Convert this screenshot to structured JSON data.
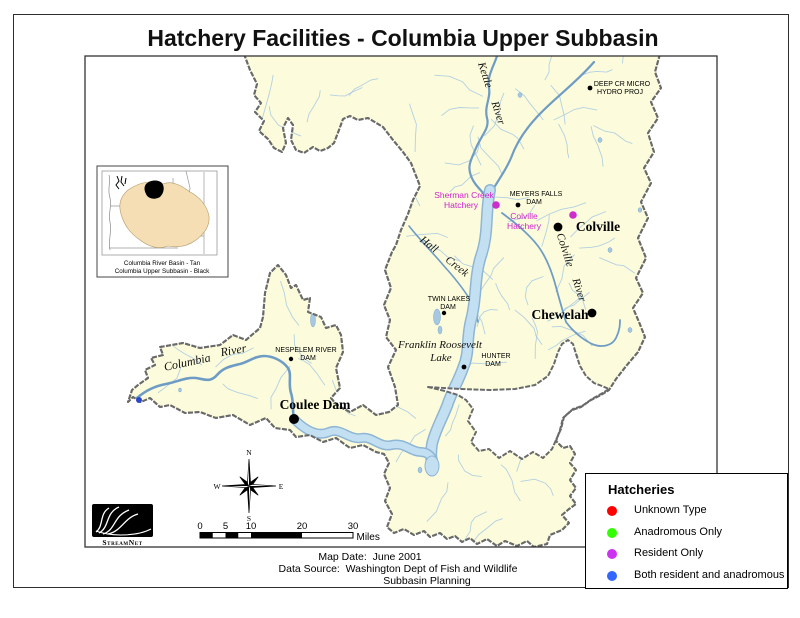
{
  "page": {
    "title": "Hatchery Facilities - Columbia Upper Subbasin"
  },
  "inset": {
    "caption_line1": "Columbia River Basin - Tan",
    "caption_line2": "Columbia Upper Subbasin - Black",
    "basin_color": "#F5DEB3",
    "subbasin_color": "#000000"
  },
  "compass": {
    "n": "N",
    "e": "E",
    "s": "S",
    "w": "W"
  },
  "logo": {
    "text": "StreamNet"
  },
  "scalebar": {
    "ticks": [
      "0",
      "5",
      "10",
      "20",
      "30"
    ],
    "unit": "Miles"
  },
  "footer": {
    "line1": "Map Date:  June 2001",
    "line2": "Data Source:  Washington Dept of Fish and Wildlife",
    "line3": "Subbasin Planning"
  },
  "legend": {
    "title": "Hatcheries",
    "items": [
      {
        "label": "Unknown Type",
        "color": "#FF0000"
      },
      {
        "label": "Anadromous Only",
        "color": "#33FF00"
      },
      {
        "label": "Resident Only",
        "color": "#CC33EE"
      },
      {
        "label": "Both resident and anadromous",
        "color": "#3366FF"
      }
    ]
  },
  "map": {
    "colors": {
      "basin": "#FCFCDC",
      "boundary": "#6A6A6A",
      "stream": "#A6C8E2",
      "river": "#6F9CC4",
      "lake_fill": "#C2E0F2",
      "lake_edge": "#8FB5D4",
      "hatchery_label": "#CC22CC"
    },
    "labels": [
      {
        "name": "kettle-river-label-1",
        "text": "Kettle",
        "x": 482,
        "y": 76,
        "rot": 72,
        "size": 11,
        "cls": "water"
      },
      {
        "name": "kettle-river-label-2",
        "text": "River",
        "x": 495,
        "y": 114,
        "rot": 72,
        "size": 11,
        "cls": "water"
      },
      {
        "name": "hall-creek-label-1",
        "text": "Hall",
        "x": 427,
        "y": 247,
        "rot": 38,
        "size": 11,
        "cls": "water"
      },
      {
        "name": "hall-creek-label-2",
        "text": "Creek",
        "x": 455,
        "y": 269,
        "rot": 38,
        "size": 11,
        "cls": "water"
      },
      {
        "name": "colville-river-label-1",
        "text": "Colville",
        "x": 562,
        "y": 251,
        "rot": 72,
        "size": 11,
        "cls": "water"
      },
      {
        "name": "colville-river-label-2",
        "text": "River",
        "x": 576,
        "y": 291,
        "rot": 72,
        "size": 11,
        "cls": "water"
      },
      {
        "name": "columbia-river-label-1",
        "text": "Columbia",
        "x": 188,
        "y": 366,
        "rot": -12,
        "size": 12,
        "cls": "water"
      },
      {
        "name": "columbia-river-label-2",
        "text": "River",
        "x": 234,
        "y": 354,
        "rot": -10,
        "size": 12,
        "cls": "water"
      },
      {
        "name": "franklin-roosevelt-lake-label-1",
        "text": "Franklin Roosevelt",
        "x": 440,
        "y": 348,
        "rot": 0,
        "size": 11,
        "cls": "water"
      },
      {
        "name": "franklin-roosevelt-lake-label-2",
        "text": "Lake",
        "x": 441,
        "y": 361,
        "rot": 0,
        "size": 11,
        "cls": "water"
      },
      {
        "name": "deep-cr-micro-label-1",
        "text": "DEEP CR MICRO",
        "x": 622,
        "y": 86,
        "rot": 0,
        "size": 7,
        "cls": "dam"
      },
      {
        "name": "deep-cr-micro-label-2",
        "text": "HYDRO PROJ",
        "x": 620,
        "y": 94,
        "rot": 0,
        "size": 7,
        "cls": "dam"
      },
      {
        "name": "meyers-falls-dam-label-1",
        "text": "MEYERS FALLS",
        "x": 536,
        "y": 196,
        "rot": 0,
        "size": 7,
        "cls": "dam"
      },
      {
        "name": "meyers-falls-dam-label-2",
        "text": "DAM",
        "x": 534,
        "y": 204,
        "rot": 0,
        "size": 7,
        "cls": "dam"
      },
      {
        "name": "twin-lakes-dam-label-1",
        "text": "TWIN LAKES",
        "x": 449,
        "y": 301,
        "rot": 0,
        "size": 7,
        "cls": "dam"
      },
      {
        "name": "twin-lakes-dam-label-2",
        "text": "DAM",
        "x": 448,
        "y": 309,
        "rot": 0,
        "size": 7,
        "cls": "dam"
      },
      {
        "name": "hunter-dam-label-1",
        "text": "HUNTER",
        "x": 496,
        "y": 358,
        "rot": 0,
        "size": 7,
        "cls": "dam"
      },
      {
        "name": "hunter-dam-label-2",
        "text": "DAM",
        "x": 493,
        "y": 366,
        "rot": 0,
        "size": 7,
        "cls": "dam"
      },
      {
        "name": "nespelem-river-dam-label-1",
        "text": "NESPELEM RIVER",
        "x": 306,
        "y": 352,
        "rot": 0,
        "size": 7,
        "cls": "dam"
      },
      {
        "name": "nespelem-river-dam-label-2",
        "text": "DAM",
        "x": 308,
        "y": 360,
        "rot": 0,
        "size": 7,
        "cls": "dam"
      },
      {
        "name": "sherman-creek-hatchery-label-1",
        "text": "Sherman Creek",
        "x": 464,
        "y": 198,
        "rot": 0,
        "size": 8.5,
        "cls": "hatchery"
      },
      {
        "name": "sherman-creek-hatchery-label-2",
        "text": "Hatchery",
        "x": 461,
        "y": 208,
        "rot": 0,
        "size": 8.5,
        "cls": "hatchery"
      },
      {
        "name": "colville-hatchery-label-1",
        "text": "Colville",
        "x": 524,
        "y": 219,
        "rot": 0,
        "size": 8.5,
        "cls": "hatchery"
      },
      {
        "name": "colville-hatchery-label-2",
        "text": "Hatchery",
        "x": 524,
        "y": 229,
        "rot": 0,
        "size": 8.5,
        "cls": "hatchery"
      },
      {
        "name": "colville-city-label",
        "text": "Colville",
        "x": 598,
        "y": 231,
        "rot": 0,
        "size": 13.5,
        "cls": "city"
      },
      {
        "name": "chewelah-city-label",
        "text": "Chewelah",
        "x": 560,
        "y": 319,
        "rot": 0,
        "size": 13.5,
        "cls": "city"
      },
      {
        "name": "coulee-dam-city-label",
        "text": "Coulee Dam",
        "x": 315,
        "y": 409,
        "rot": 0,
        "size": 13.5,
        "cls": "city"
      }
    ],
    "points": [
      {
        "name": "deep-cr-micro-hydro-proj-point",
        "x": 590,
        "y": 88,
        "r": 2.4,
        "color": "#000000"
      },
      {
        "name": "sherman-creek-hatchery-point",
        "x": 496,
        "y": 205,
        "r": 3.8,
        "color": "#CC2ECC"
      },
      {
        "name": "meyers-falls-dam-point",
        "x": 518,
        "y": 205,
        "r": 2.4,
        "color": "#000000"
      },
      {
        "name": "colville-hatchery-point",
        "x": 573,
        "y": 215,
        "r": 3.8,
        "color": "#CC2ECC"
      },
      {
        "name": "colville-city-point",
        "x": 558,
        "y": 227,
        "r": 4.4,
        "color": "#000000"
      },
      {
        "name": "chewelah-city-point",
        "x": 592,
        "y": 313,
        "r": 4.4,
        "color": "#000000"
      },
      {
        "name": "twin-lakes-dam-point",
        "x": 444,
        "y": 313,
        "r": 2.2,
        "color": "#000000"
      },
      {
        "name": "hunter-dam-point",
        "x": 464,
        "y": 367,
        "r": 2.4,
        "color": "#000000"
      },
      {
        "name": "nespelem-river-dam-point",
        "x": 291,
        "y": 359,
        "r": 2.2,
        "color": "#000000"
      },
      {
        "name": "coulee-dam-city-point",
        "x": 294,
        "y": 419,
        "r": 5.0,
        "color": "#000000"
      },
      {
        "name": "columbia-west-point",
        "x": 139,
        "y": 400,
        "r": 3.0,
        "color": "#2B49C6"
      }
    ]
  }
}
